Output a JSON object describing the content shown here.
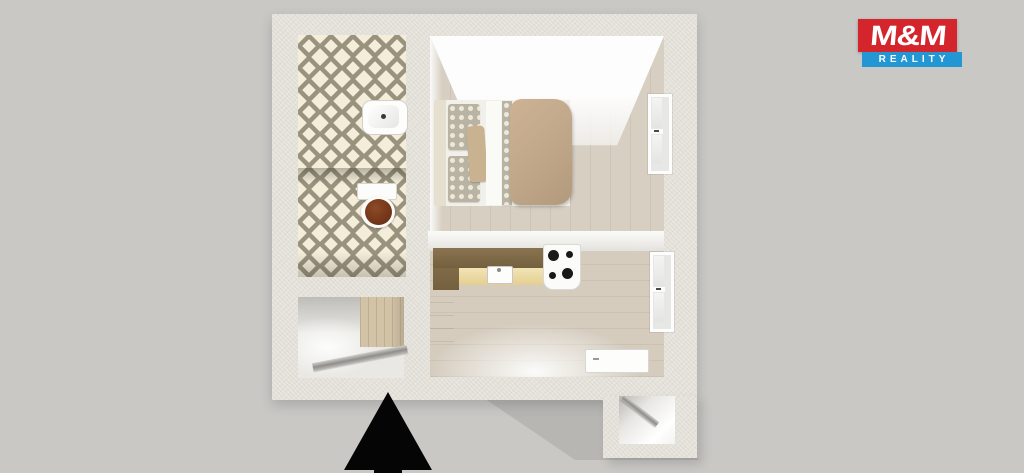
{
  "logo": {
    "name": "M&M",
    "tagline": "REALITY",
    "name_bg": "#d4252c",
    "tagline_bg": "#2396d4",
    "text_color": "#ffffff"
  },
  "scene": {
    "type": "3d-floor-plan-render",
    "background": "#c9c8c5",
    "wall_color": "#e9e6e0",
    "wood_floor": "#d7cfc2",
    "bathroom_tile_base": "#f3edda",
    "bathroom_tile_accent": "#99937d",
    "bed_duvet": "#c2a88b",
    "kitchen_counter": "#7d6848",
    "kitchen_cabinet_front": "#ecd9a4",
    "toilet_seat": "#7c3a1d",
    "entrance_arrow_color": "#000000"
  },
  "icons": {
    "entrance_arrow": "▲"
  }
}
